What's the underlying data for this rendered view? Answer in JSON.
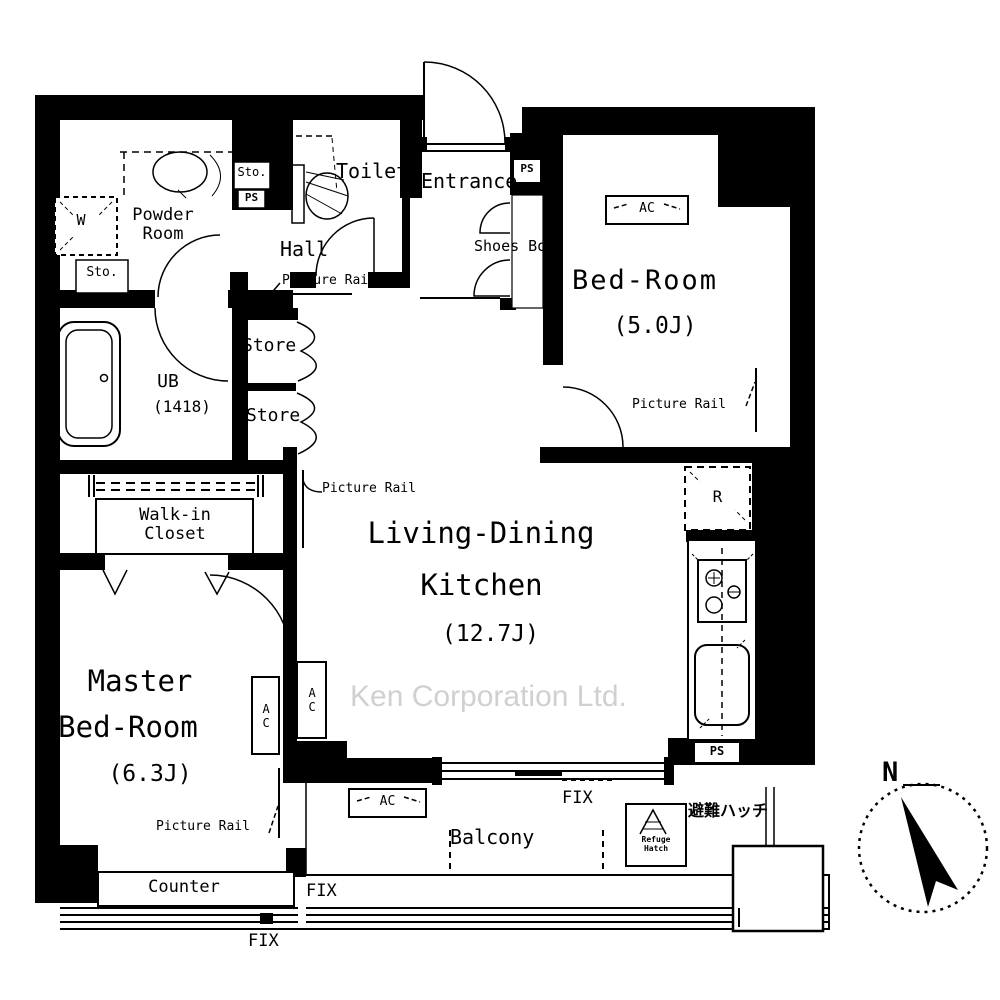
{
  "watermark": "Ken Corporation Ltd.",
  "compass": {
    "north": "N"
  },
  "rooms": {
    "powder_room": {
      "line1": "Powder",
      "line2": "Room"
    },
    "toilet": "Toilet",
    "entrance": "Entrance",
    "shoes_box": "Shoes Box",
    "hall": "Hall",
    "bed_room": {
      "name": "Bed-Room",
      "size": "(5.0J)"
    },
    "ub": {
      "name": "UB",
      "size": "(1418)"
    },
    "walk_in_closet": {
      "line1": "Walk-in",
      "line2": "Closet"
    },
    "ldk": {
      "line1": "Living-Dining",
      "line2": "Kitchen",
      "size": "(12.7J)"
    },
    "master_bed_room": {
      "line1": "Master",
      "line2": "Bed-Room",
      "size": "(6.3J)"
    },
    "balcony": "Balcony"
  },
  "labels": {
    "picture_rail": "Picture Rail",
    "store": "Store",
    "counter": "Counter",
    "fix": "FIX",
    "ac": "AC",
    "ps": "PS",
    "sto": "Sto.",
    "washer": "W",
    "fridge": "R",
    "refuge_line1": "Refuge",
    "refuge_line2": "Hatch",
    "evacuation_hatch_jp": "避難ハッチ"
  },
  "colors": {
    "line": "#000000",
    "watermark": "#c8c8c8",
    "background": "#ffffff"
  }
}
